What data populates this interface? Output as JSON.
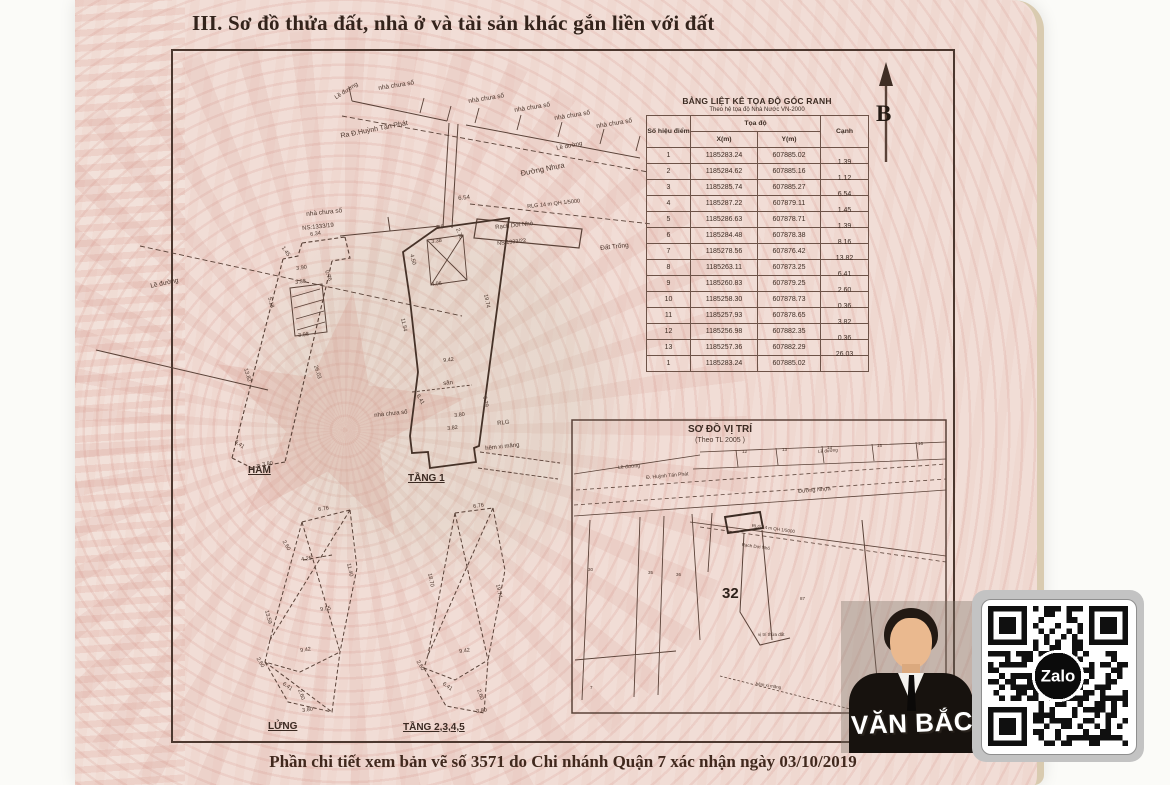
{
  "page": {
    "section_title": "III. Sơ đồ thửa đất, nhà ở và tài sản khác gắn liền với đất",
    "footer_note": "Phần chi tiết xem bản vẽ số 3571 do Chi nhánh Quận 7 xác nhận ngày 03/10/2019"
  },
  "compass": {
    "label": "B"
  },
  "coordinate_table": {
    "title": "BẢNG LIỆT KÊ TỌA ĐỘ GÓC RANH",
    "subtitle": "Theo hệ tọa độ Nhà Nước VN-2000",
    "col_point": "Số hiệu điểm",
    "col_coords": "Tọa độ",
    "col_x": "X(m)",
    "col_y": "Y(m)",
    "col_edge": "Cạnh",
    "rows": [
      {
        "p": "1",
        "x": "1185283.24",
        "y": "607885.02",
        "c": "1.39"
      },
      {
        "p": "2",
        "x": "1185284.62",
        "y": "607885.16",
        "c": "1.12"
      },
      {
        "p": "3",
        "x": "1185285.74",
        "y": "607885.27",
        "c": "6.54"
      },
      {
        "p": "4",
        "x": "1185287.22",
        "y": "607879.11",
        "c": "1.45"
      },
      {
        "p": "5",
        "x": "1185286.63",
        "y": "607878.71",
        "c": "1.39"
      },
      {
        "p": "6",
        "x": "1185284.48",
        "y": "607878.38",
        "c": "8.16"
      },
      {
        "p": "7",
        "x": "1185278.56",
        "y": "607876.42",
        "c": "13.82"
      },
      {
        "p": "8",
        "x": "1185263.11",
        "y": "607873.25",
        "c": "6.41"
      },
      {
        "p": "9",
        "x": "1185260.83",
        "y": "607879.25",
        "c": "2.60"
      },
      {
        "p": "10",
        "x": "1185258.30",
        "y": "607878.73",
        "c": "0.36"
      },
      {
        "p": "11",
        "x": "1185257.93",
        "y": "607878.65",
        "c": "3.82"
      },
      {
        "p": "12",
        "x": "1185256.98",
        "y": "607882.35",
        "c": "0.36"
      },
      {
        "p": "13",
        "x": "1185257.36",
        "y": "607882.29",
        "c": "26.03"
      },
      {
        "p": "1",
        "x": "1185283.24",
        "y": "607885.02",
        "c": ""
      }
    ]
  },
  "location_map": {
    "title": "SƠ ĐỒ VỊ TRÍ",
    "subtitle": "(Theo TL 2005 )",
    "parcel": "32"
  },
  "floor_plans": {
    "basement": "HẦM",
    "floor1": "TẦNG 1",
    "mezzanine": "LỬNG",
    "upper": "TẦNG 2,3,4,5"
  },
  "watermark": {
    "agent_name": "VĂN BẮC",
    "qr_logo": "Zalo"
  },
  "colors": {
    "paper": "#f1ddd6",
    "ink": "#4a342a",
    "pattern": "#d5958a",
    "edge_strip": "#d9cbb0"
  },
  "annotations": [
    {
      "t": "nhà chưa số",
      "x": 378,
      "y": 86,
      "r": -9,
      "s": 6.5
    },
    {
      "t": "Lề đường",
      "x": 334,
      "y": 96,
      "r": -33,
      "s": 6
    },
    {
      "t": "nhà chưa số",
      "x": 468,
      "y": 99,
      "r": -9,
      "s": 6.5
    },
    {
      "t": "nhà chưa số",
      "x": 514,
      "y": 108,
      "r": -9,
      "s": 6.5
    },
    {
      "t": "nhà chưa số",
      "x": 554,
      "y": 116,
      "r": -9,
      "s": 6.5
    },
    {
      "t": "nhà chưa số",
      "x": 596,
      "y": 124,
      "r": -9,
      "s": 6.5
    },
    {
      "t": "Lề đường",
      "x": 556,
      "y": 146,
      "r": -11,
      "s": 6
    },
    {
      "t": "Ra Đ.Huỳnh Tấn Phát",
      "x": 340,
      "y": 133,
      "r": -11,
      "s": 7
    },
    {
      "t": "Đường Nhựa",
      "x": 520,
      "y": 170,
      "r": -11,
      "s": 7.5
    },
    {
      "t": "Lề đường",
      "x": 150,
      "y": 284,
      "r": -12,
      "s": 6.5
    },
    {
      "t": "nhà chưa số",
      "x": 306,
      "y": 212,
      "r": -6,
      "s": 6.5
    },
    {
      "t": "NS:1333/19",
      "x": 302,
      "y": 226,
      "r": -6,
      "s": 6
    },
    {
      "t": "6.54",
      "x": 458,
      "y": 196,
      "r": -6,
      "s": 6
    },
    {
      "t": "RLG 14 m QH 1/5000",
      "x": 527,
      "y": 205,
      "r": -6,
      "s": 5.5
    },
    {
      "t": "Rạch Dơi Nhỏ",
      "x": 495,
      "y": 225,
      "r": -6,
      "s": 6
    },
    {
      "t": "NS 1333/22",
      "x": 497,
      "y": 242,
      "r": -6,
      "s": 5.5
    },
    {
      "t": "Đất Trống",
      "x": 600,
      "y": 246,
      "r": -6,
      "s": 6.5
    },
    {
      "t": "3.9",
      "x": 436,
      "y": 226,
      "r": -6,
      "s": 5.5
    },
    {
      "t": "2.76",
      "x": 459,
      "y": 228,
      "r": 70,
      "s": 5.5
    },
    {
      "t": "3.38",
      "x": 431,
      "y": 240,
      "r": -6,
      "s": 5.5
    },
    {
      "t": "4.50",
      "x": 413,
      "y": 254,
      "r": 75,
      "s": 5.5
    },
    {
      "t": "4.06",
      "x": 431,
      "y": 283,
      "r": -6,
      "s": 5.5
    },
    {
      "t": "11.54",
      "x": 404,
      "y": 318,
      "r": 78,
      "s": 5.5
    },
    {
      "t": "19.74",
      "x": 487,
      "y": 294,
      "r": 78,
      "s": 5.5
    },
    {
      "t": "6.29",
      "x": 486,
      "y": 396,
      "r": 78,
      "s": 5.5
    },
    {
      "t": "9.42",
      "x": 443,
      "y": 359,
      "r": -6,
      "s": 5.5
    },
    {
      "t": "sân",
      "x": 443,
      "y": 381,
      "r": -6,
      "s": 6
    },
    {
      "t": "6.41",
      "x": 419,
      "y": 394,
      "r": 60,
      "s": 5.5
    },
    {
      "t": "nhà chưa số",
      "x": 374,
      "y": 413,
      "r": -6,
      "s": 6
    },
    {
      "t": "3.80",
      "x": 454,
      "y": 414,
      "r": -6,
      "s": 5.5
    },
    {
      "t": "3.82",
      "x": 447,
      "y": 427,
      "r": -6,
      "s": 5.5
    },
    {
      "t": "RLG",
      "x": 497,
      "y": 421,
      "r": -6,
      "s": 6
    },
    {
      "t": "hẻm xi măng",
      "x": 485,
      "y": 446,
      "r": -6,
      "s": 6
    },
    {
      "t": "6.34",
      "x": 310,
      "y": 233,
      "r": -8,
      "s": 5.5
    },
    {
      "t": "1.45",
      "x": 284,
      "y": 246,
      "r": 55,
      "s": 5.5
    },
    {
      "t": "3.90",
      "x": 296,
      "y": 267,
      "r": -8,
      "s": 5.5
    },
    {
      "t": "0.76",
      "x": 328,
      "y": 270,
      "r": 70,
      "s": 5.5
    },
    {
      "t": "3.38",
      "x": 295,
      "y": 281,
      "r": -8,
      "s": 5.5
    },
    {
      "t": "5.18",
      "x": 271,
      "y": 297,
      "r": 75,
      "s": 5.5
    },
    {
      "t": "3.98",
      "x": 298,
      "y": 334,
      "r": -8,
      "s": 5.5
    },
    {
      "t": "13.82",
      "x": 247,
      "y": 368,
      "r": 73,
      "s": 5.5
    },
    {
      "t": "26.03",
      "x": 317,
      "y": 365,
      "r": 73,
      "s": 5.5
    },
    {
      "t": "6.41",
      "x": 236,
      "y": 440,
      "r": 35,
      "s": 5.5
    },
    {
      "t": "3.80",
      "x": 262,
      "y": 463,
      "r": -8,
      "s": 5.5
    },
    {
      "t": "6.76",
      "x": 318,
      "y": 508,
      "r": -8,
      "s": 5.5
    },
    {
      "t": "2.60",
      "x": 285,
      "y": 540,
      "r": 60,
      "s": 5.5
    },
    {
      "t": "4.25",
      "x": 301,
      "y": 558,
      "r": -8,
      "s": 5.5
    },
    {
      "t": "11.40",
      "x": 350,
      "y": 563,
      "r": 78,
      "s": 5.5
    },
    {
      "t": "13.59",
      "x": 268,
      "y": 610,
      "r": 75,
      "s": 5.5
    },
    {
      "t": "9.55",
      "x": 320,
      "y": 608,
      "r": -8,
      "s": 5.5
    },
    {
      "t": "9.42",
      "x": 300,
      "y": 649,
      "r": -8,
      "s": 5.5
    },
    {
      "t": "2.60",
      "x": 259,
      "y": 657,
      "r": 60,
      "s": 5.5
    },
    {
      "t": "6.41",
      "x": 284,
      "y": 682,
      "r": 35,
      "s": 5.5
    },
    {
      "t": "2.60",
      "x": 301,
      "y": 689,
      "r": 70,
      "s": 5.5
    },
    {
      "t": "3.80",
      "x": 302,
      "y": 709,
      "r": -8,
      "s": 5.5
    },
    {
      "t": "6.76",
      "x": 473,
      "y": 505,
      "r": -8,
      "s": 5.5
    },
    {
      "t": "18.70",
      "x": 431,
      "y": 573,
      "r": 78,
      "s": 5.5
    },
    {
      "t": "19.74",
      "x": 499,
      "y": 584,
      "r": 78,
      "s": 5.5
    },
    {
      "t": "9.42",
      "x": 459,
      "y": 650,
      "r": -8,
      "s": 5.5
    },
    {
      "t": "2.60",
      "x": 419,
      "y": 660,
      "r": 60,
      "s": 5.5
    },
    {
      "t": "6.41",
      "x": 444,
      "y": 682,
      "r": 35,
      "s": 5.5
    },
    {
      "t": "2.60",
      "x": 480,
      "y": 689,
      "r": 70,
      "s": 5.5
    },
    {
      "t": "3.80",
      "x": 476,
      "y": 710,
      "r": -8,
      "s": 5.5
    },
    {
      "t": "Lề đường",
      "x": 618,
      "y": 466,
      "r": -5,
      "s": 5
    },
    {
      "t": "Đ. Huỳnh Tấn Phát",
      "x": 646,
      "y": 476,
      "r": -5,
      "s": 5
    },
    {
      "t": "Lề đường",
      "x": 818,
      "y": 450,
      "r": -5,
      "s": 4.5
    },
    {
      "t": "Đường Nhựa",
      "x": 798,
      "y": 490,
      "r": -5,
      "s": 5.5
    },
    {
      "t": "RLG 14 m QH 1/5000",
      "x": 752,
      "y": 524,
      "r": 8,
      "s": 4.5
    },
    {
      "t": "Rạch Dơi Nhỏ",
      "x": 742,
      "y": 543,
      "r": 8,
      "s": 4.5
    },
    {
      "t": "12",
      "x": 742,
      "y": 450,
      "r": 0,
      "s": 4.5
    },
    {
      "t": "13",
      "x": 782,
      "y": 448,
      "r": 0,
      "s": 4.5
    },
    {
      "t": "14",
      "x": 827,
      "y": 446,
      "r": 0,
      "s": 4.5
    },
    {
      "t": "15",
      "x": 877,
      "y": 444,
      "r": 0,
      "s": 4.5
    },
    {
      "t": "16",
      "x": 918,
      "y": 442,
      "r": 0,
      "s": 4.5
    },
    {
      "t": "30",
      "x": 588,
      "y": 568,
      "r": 0,
      "s": 4.5
    },
    {
      "t": "35",
      "x": 648,
      "y": 571,
      "r": 0,
      "s": 4.5
    },
    {
      "t": "36",
      "x": 676,
      "y": 573,
      "r": 0,
      "s": 4.5
    },
    {
      "t": "87",
      "x": 800,
      "y": 597,
      "r": 0,
      "s": 4.5
    },
    {
      "t": "7",
      "x": 590,
      "y": 686,
      "r": 0,
      "s": 4.5
    },
    {
      "t": "vị trí thửa đất",
      "x": 758,
      "y": 633,
      "r": 0,
      "s": 4.5
    },
    {
      "t": "hẻm xi măng",
      "x": 756,
      "y": 682,
      "r": 9,
      "s": 4.5
    }
  ]
}
